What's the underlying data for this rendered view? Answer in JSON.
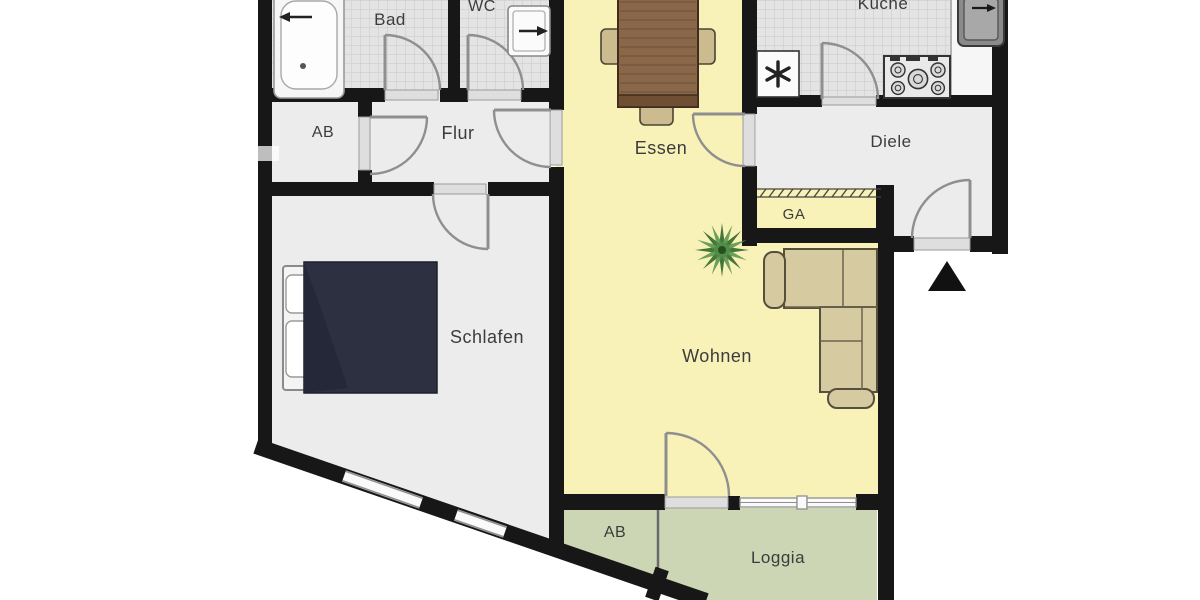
{
  "floorplan": {
    "type": "apartment-floor-plan",
    "labels": {
      "bad": "Bad",
      "wc": "WC",
      "kueche": "Küche",
      "ab_top": "AB",
      "flur": "Flur",
      "essen": "Essen",
      "diele": "Diele",
      "ga": "GA",
      "schlafen": "Schlafen",
      "wohnen": "Wohnen",
      "ab_bottom": "AB",
      "loggia": "Loggia"
    },
    "colors": {
      "wall": "#171717",
      "room_gray": "#ececec",
      "tile_gray": "#e4e4e4",
      "living_yellow": "#f8f1b8",
      "balcony_green": "#ccd6b5",
      "sofa_tan": "#d6cba0",
      "chair_tan": "#cbbb8e",
      "table_brown": "#8a6748",
      "bed_navy": "#2c3040",
      "plant_green": "#3c6e33",
      "label_text": "#3c3c3c"
    }
  }
}
